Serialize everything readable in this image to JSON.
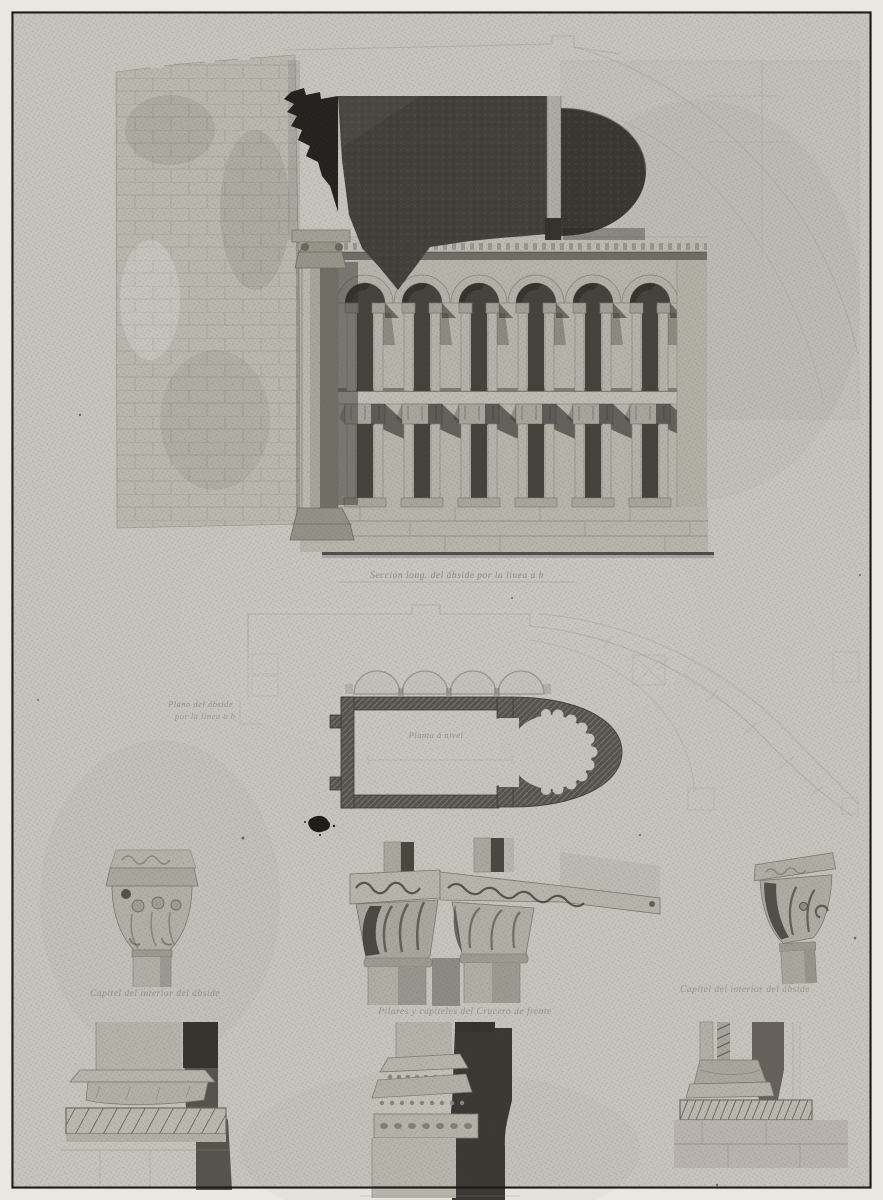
{
  "plate": {
    "kind": "scanned architectural plate",
    "subject": "Romanesque apse: longitudinal section, ground plan, capitals and base mouldings",
    "captions": {
      "section": "Sección long. del ábside por la línea a b",
      "plan_side_1": "Plano del ábside",
      "plan_side_2": "por la línea a b",
      "plan_inner": "Planta á nivel",
      "capital_left": "Capitel del interior del ábside",
      "capitals_center": "Pilares y capiteles del Crucero de frente",
      "capital_right": "Capitel del interior del ábside"
    }
  },
  "colors": {
    "margin": "#e9e7e1",
    "paper": "#c6c3bd",
    "stone": "#b7b4ac",
    "line": "#8b887f",
    "faint": "#a5a29a",
    "inkdark": "#3d3a34",
    "inkblack": "#23221f",
    "wall": "#56534c",
    "caption": "#7f7c73",
    "border": "#1d1c19"
  }
}
